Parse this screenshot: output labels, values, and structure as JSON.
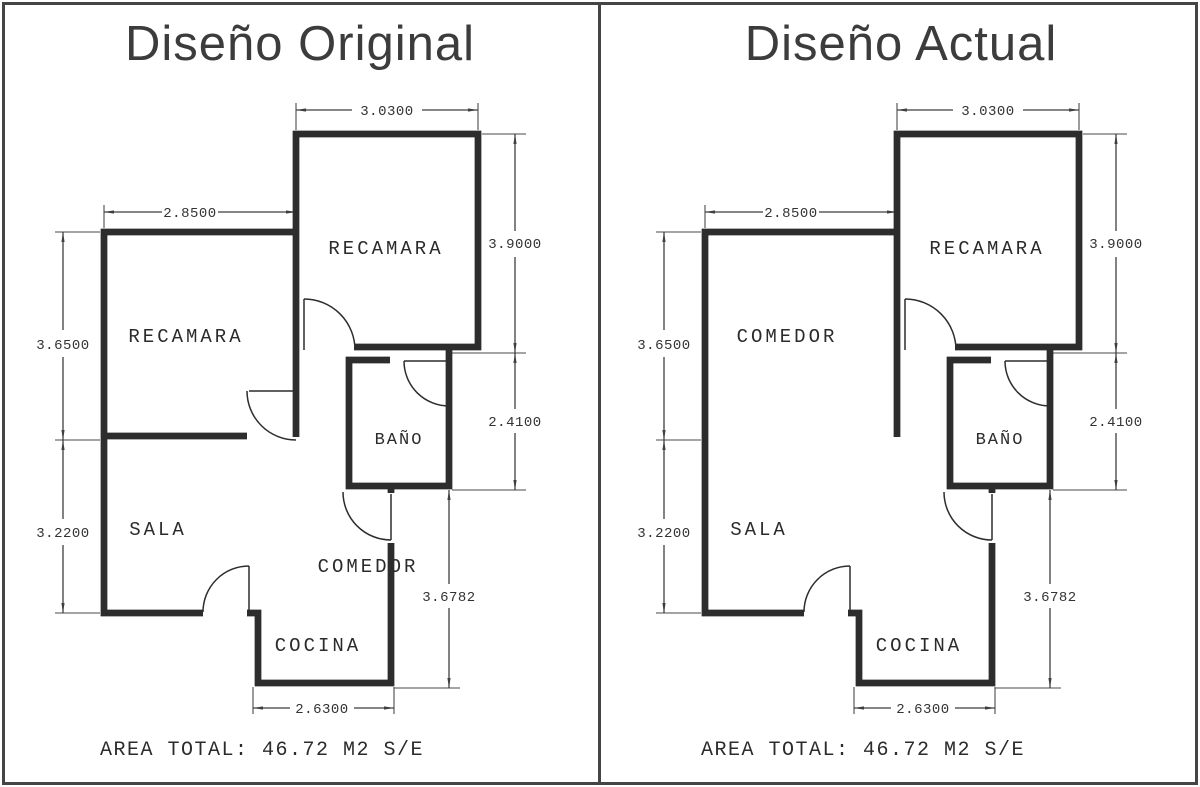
{
  "window": {
    "width": 1200,
    "height": 787,
    "background": "#ffffff",
    "border_color": "#454545",
    "wall_color": "#2d2d2d",
    "dimension_color": "#3f3f3f"
  },
  "panels": [
    {
      "title": "Diseño Original",
      "rooms": {
        "top_room": "RECAMARA",
        "left_room": "RECAMARA",
        "sala": "SALA",
        "bano": "BAÑO",
        "comedor": "COMEDOR",
        "cocina": "COCINA"
      },
      "dims": {
        "top_width": "3.0300",
        "left_width": "2.8500",
        "left_upper": "3.6500",
        "left_lower": "3.2200",
        "right_upper": "3.9000",
        "right_mid": "2.4100",
        "right_lower": "3.6782",
        "bottom_width": "2.6300"
      },
      "area_total": "AREA TOTAL: 46.72 M2 S/E"
    },
    {
      "title": "Diseño Actual",
      "rooms": {
        "top_room": "RECAMARA",
        "left_room": "COMEDOR",
        "sala": "SALA",
        "bano": "BAÑO",
        "cocina": "COCINA"
      },
      "dims": {
        "top_width": "3.0300",
        "left_width": "2.8500",
        "left_upper": "3.6500",
        "left_lower": "3.2200",
        "right_upper": "3.9000",
        "right_mid": "2.4100",
        "right_lower": "3.6782",
        "bottom_width": "2.6300"
      },
      "area_total": "AREA TOTAL: 46.72 M2 S/E"
    }
  ]
}
